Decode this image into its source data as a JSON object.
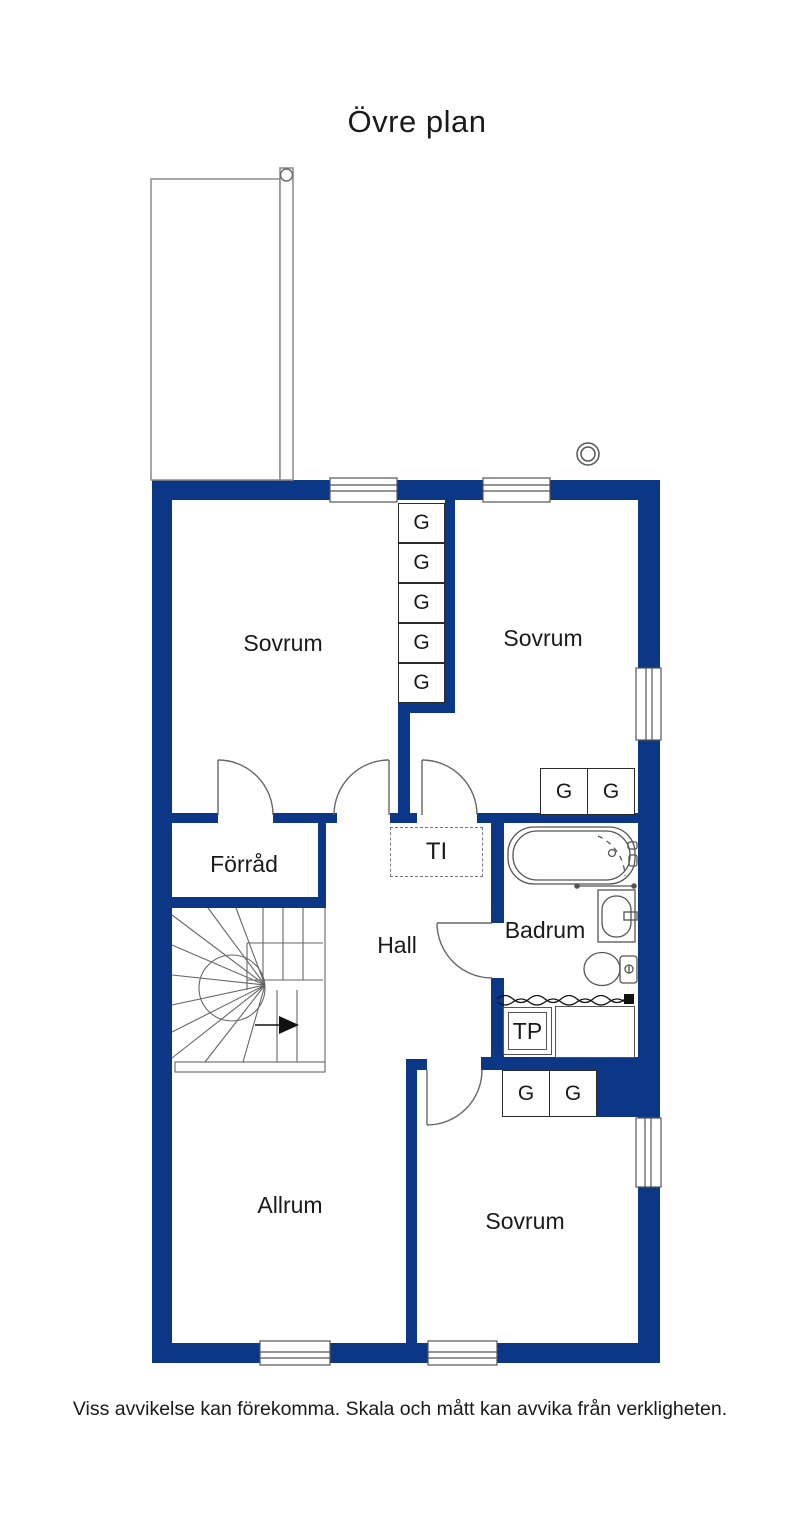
{
  "title": "Övre plan",
  "disclaimer": "Viss avvikelse kan förekomma. Skala och mått kan avvika från verkligheten.",
  "rooms": {
    "bedroom_top_left": "Sovrum",
    "bedroom_top_right": "Sovrum",
    "storage": "Förråd",
    "hall": "Hall",
    "bathroom": "Badrum",
    "living_room": "Allrum",
    "bedroom_bottom": "Sovrum"
  },
  "labels": {
    "wardrobe": "G",
    "tp": "TP",
    "ti": "TI"
  },
  "colors": {
    "wall": "#0c3787",
    "fixture_line": "#555555",
    "text": "#1a1a1a"
  }
}
